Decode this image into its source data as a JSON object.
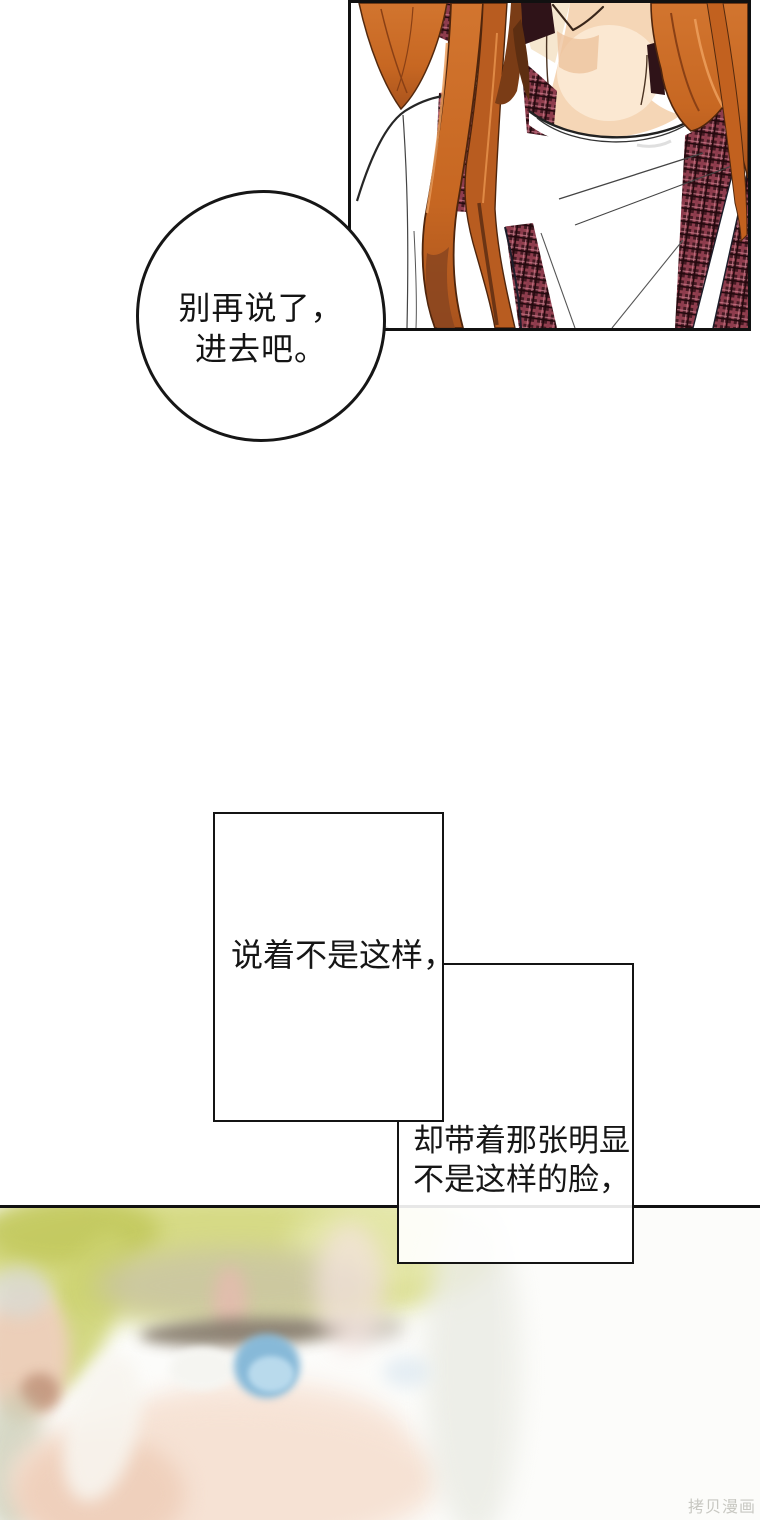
{
  "page": {
    "width": 760,
    "height": 1520,
    "background": "#ffffff"
  },
  "speech_bubble": {
    "lines": [
      "别再说了，",
      "进去吧。"
    ]
  },
  "captions": [
    {
      "lines": [
        "说着不是这样，"
      ]
    },
    {
      "lines": [
        "却带着那张明显",
        "不是这样的脸，"
      ]
    }
  ],
  "watermark": {
    "text": "拷贝漫画"
  },
  "panels": {
    "top_panel": {
      "description": "close-up from chin down of a character with long copper-orange hair, white tee and dark maroon plaid cardigan straps",
      "border_color": "#111111",
      "colors": {
        "hair": "#c76722",
        "hair_dark": "#6b3414",
        "hair_highlight": "#eb9c5a",
        "skin": "#f5d6b6",
        "plaid_base": "#461a23",
        "plaid_line": "#93404f",
        "shade": "#e3e3e3"
      }
    },
    "bottom_panel": {
      "description": "heavily blurred close-up of a blond character's face showing one blue eye and an ear",
      "border_color": "#111111",
      "colors": {
        "hair": "#d6da85",
        "iris": "#87b9d8",
        "lash": "#857a6c",
        "skin": "#f6e2d4"
      }
    }
  },
  "text_color": "#141414"
}
